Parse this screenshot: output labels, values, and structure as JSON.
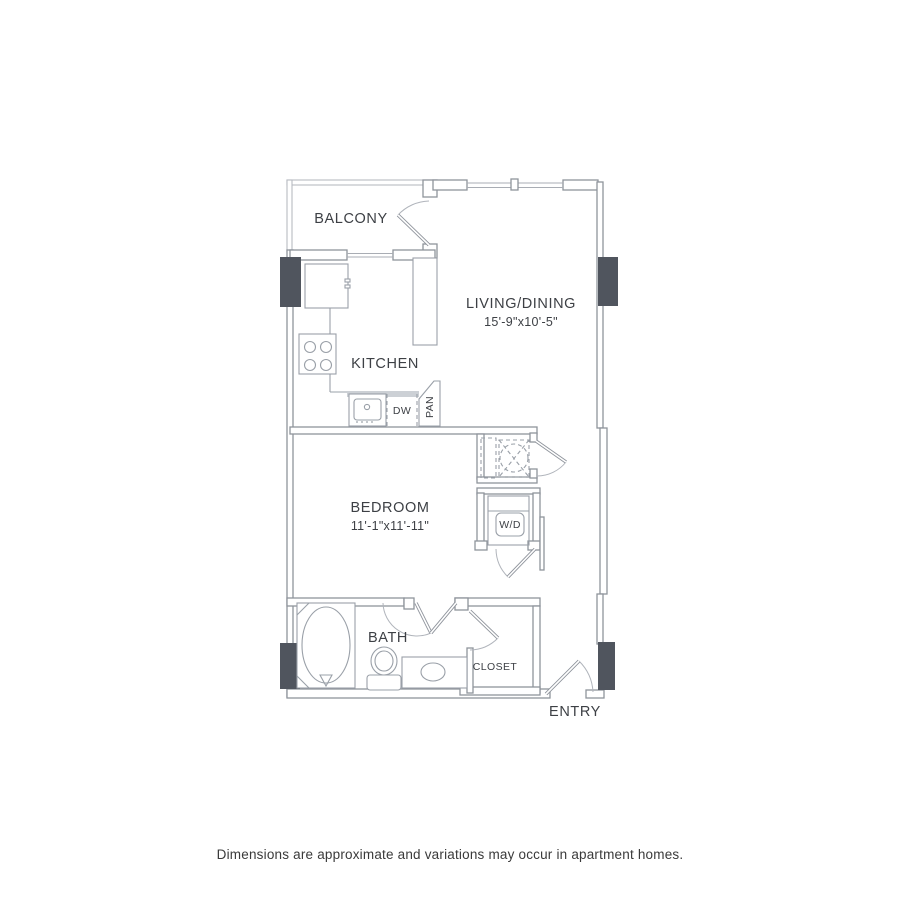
{
  "plan": {
    "rooms": {
      "balcony": {
        "label": "BALCONY"
      },
      "living_dining": {
        "label": "LIVING/DINING",
        "dimensions": "15'-9\"x10'-5\""
      },
      "kitchen": {
        "label": "KITCHEN"
      },
      "bedroom": {
        "label": "BEDROOM",
        "dimensions": "11'-1\"x11'-11\""
      },
      "bath": {
        "label": "BATH"
      },
      "closet": {
        "label": "CLOSET"
      },
      "entry": {
        "label": "ENTRY"
      }
    },
    "fixtures": {
      "dishwasher": "DW",
      "pantry": "PAN",
      "washer_dryer": "W/D"
    },
    "colors": {
      "wall": "#8f949c",
      "wall_light": "#b7bbc1",
      "column": "#50555e",
      "text": "#3d4045"
    }
  },
  "footer": {
    "disclaimer": "Dimensions are approximate and variations may occur in apartment homes."
  }
}
